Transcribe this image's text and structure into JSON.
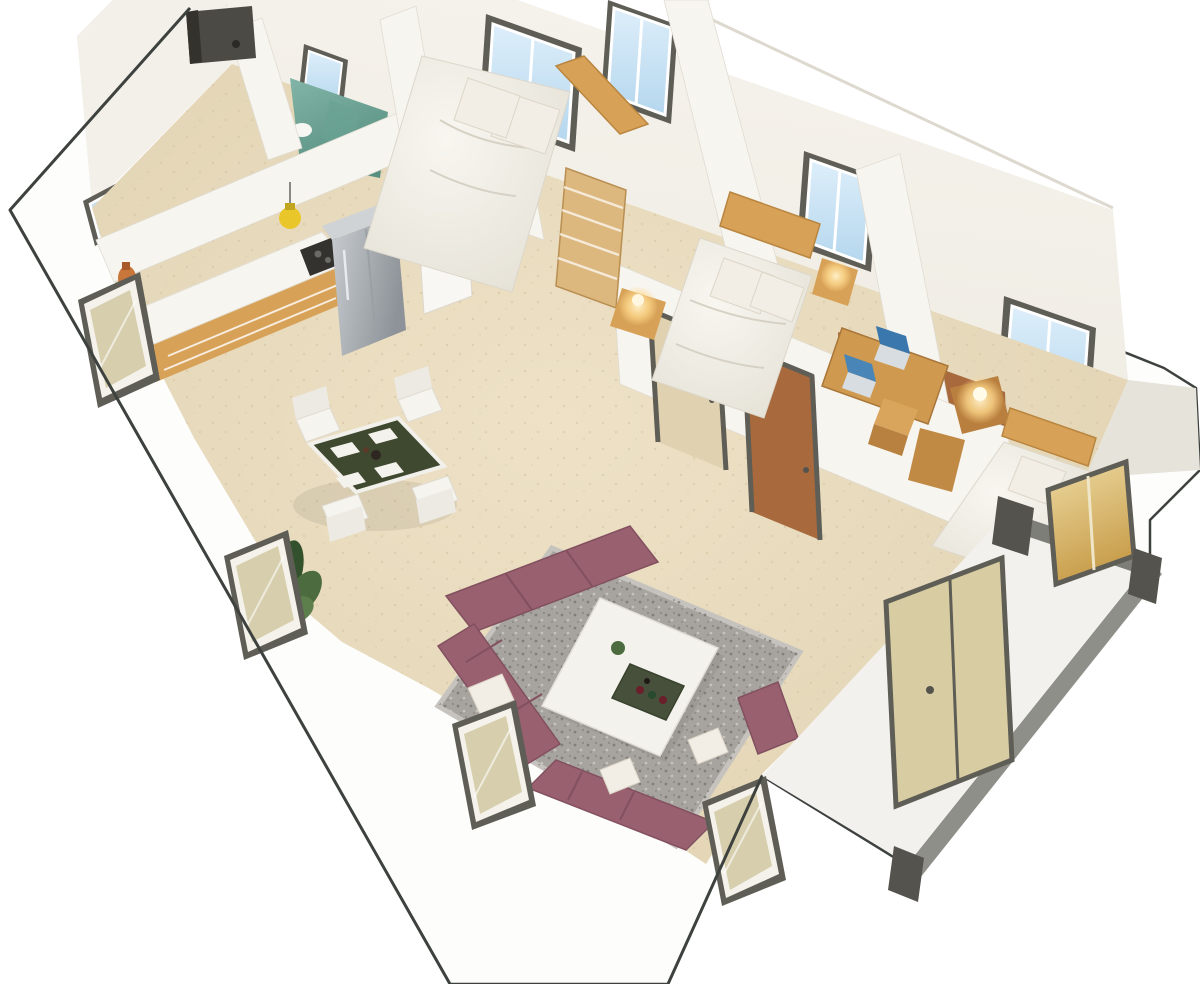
{
  "title": "3D isometric cutaway floor plan render of an expandable prefab container home",
  "alt": "Top-down 3D rendering of a small home: kitchen with L-shaped wood counter and fridge at top left, teal-floored bathroom at top, three bedrooms with white bedding and wood headboards along the top-right wall, a desk with laptops in the right bedroom, a dining table with dark green top and four white chairs, and a living room with mauve modular sofa, gray rug and white coffee table; entry porch module at lower right.",
  "rooms": [
    {
      "id": "bathroom",
      "label": "Bathroom"
    },
    {
      "id": "bedroom-1",
      "label": "Bedroom 1"
    },
    {
      "id": "bedroom-2",
      "label": "Bedroom 2"
    },
    {
      "id": "bedroom-3-office",
      "label": "Bedroom 3 / Office"
    },
    {
      "id": "kitchen",
      "label": "Kitchen"
    },
    {
      "id": "dining-area",
      "label": "Dining Area"
    },
    {
      "id": "living-room",
      "label": "Living Room"
    },
    {
      "id": "entry-porch",
      "label": "Entry Porch"
    }
  ],
  "furniture": [
    "l-shaped-kitchen-counter",
    "refrigerator",
    "cooktop",
    "yellow-pendant-lamp",
    "tall-cabinet",
    "double-bed-1",
    "double-bed-2",
    "double-bed-3",
    "nightstand-lamps",
    "wood-ladder-shelf",
    "desk-with-laptops",
    "desk-chair",
    "dining-table",
    "dining-chairs",
    "potted-plant",
    "mauve-sectional-sofa",
    "gray-rug",
    "white-coffee-table",
    "drinks-tray",
    "porch-door"
  ],
  "palette": {
    "outline": "#3e423f",
    "wall": "#efece4",
    "wall_shade": "#e0dcd2",
    "wall_white": "#fdfdfc",
    "glass_top": "#ddeefa",
    "glass_bot": "#b5d7ee",
    "frame": "#5f5e56",
    "floor_hi": "#eee1c6",
    "floor_lo": "#e0d2b1",
    "floor_dot": "#d3c29c",
    "teal": "#82b5a7",
    "teal_deep": "#578f80",
    "wood": "#d7a258",
    "wood_deep": "#b97f3e",
    "wood_floor": "#a8693d",
    "fridge_hi": "#c8ccd0",
    "fridge_lo": "#8d9398",
    "cooktop": "#34322e",
    "pendant": "#e9c72b",
    "glow": "#ffd98c",
    "sofa": "#996070",
    "sofa_deep": "#82505f",
    "pillow": "#f2ede5",
    "rug": "#a7a49f",
    "rug_dot": "#7e7b76",
    "rug_lite": "#cac7c2",
    "olive": "#3f4930",
    "chair": "#f6f4ef",
    "ctable": "#f4f2ed",
    "tan_door": "#d8cca2",
    "gold_hi": "#eddaa2",
    "gold_lo": "#c89d4a",
    "post": "#55534d",
    "metal": "#8f8f89",
    "plant": "#4c6b3f",
    "plant_deep": "#32512c"
  }
}
